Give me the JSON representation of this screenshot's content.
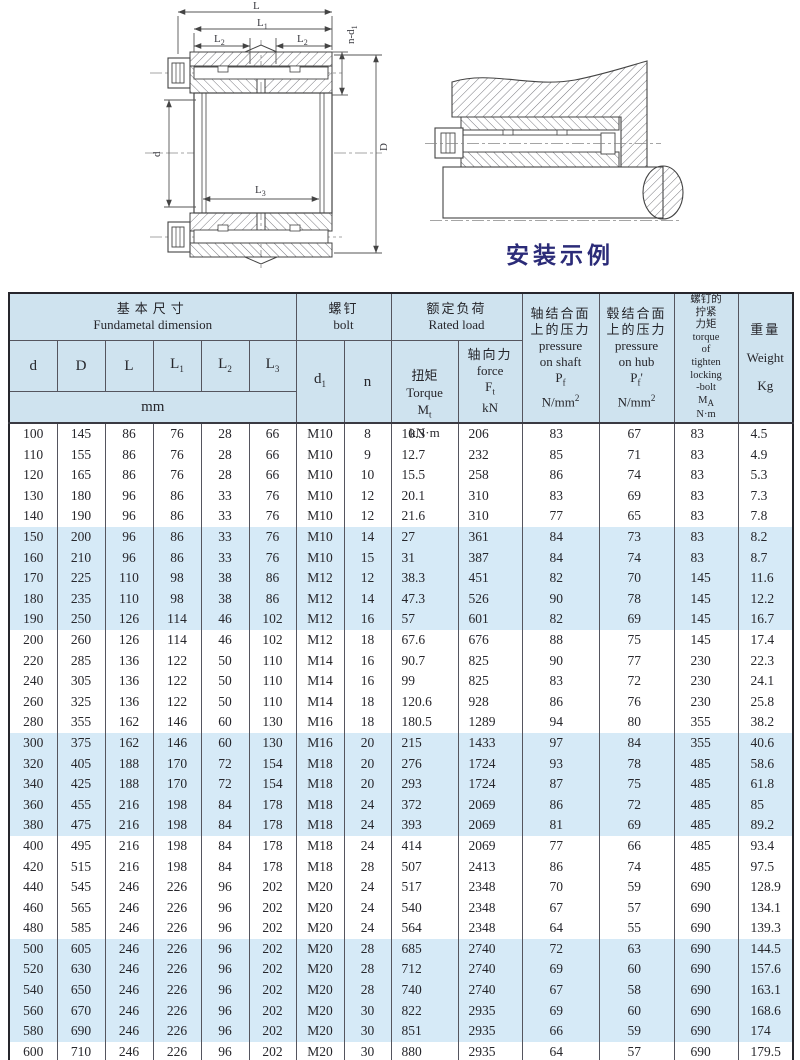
{
  "drawings": {
    "left": {
      "labels": {
        "L": "L",
        "L1": {
          "b": "L",
          "s": "1"
        },
        "L2": {
          "b": "L",
          "s": "2"
        },
        "L3": {
          "b": "L",
          "s": "3"
        },
        "nd1": {
          "b": "n-d",
          "s": "1"
        },
        "d": "d",
        "D": "D"
      }
    },
    "right": {
      "caption": "安装示例",
      "caption_color": "#2b2b78"
    }
  },
  "table": {
    "header": {
      "basic": {
        "cn": "基本尺寸",
        "en": "Fundametal  dimension"
      },
      "mm": "mm",
      "bolt": {
        "cn": "螺钉",
        "en": "bolt"
      },
      "rated": {
        "cn": "额定负荷",
        "en": "Rated load"
      },
      "cols": {
        "d": "d",
        "Dd": "D",
        "L": "L",
        "L1": {
          "b": "L",
          "s": "1"
        },
        "L2": {
          "b": "L",
          "s": "2"
        },
        "L3": {
          "b": "L",
          "s": "3"
        },
        "d1": {
          "b": "d",
          "s": "1"
        },
        "n": "n"
      },
      "torque": {
        "cn": "扭矩",
        "en": "Torque",
        "sym": "M",
        "sub": "t",
        "unit": "kN·m"
      },
      "force": {
        "cn": "轴向力",
        "en": "force",
        "sym": "F",
        "sub": "t",
        "unit": "kN"
      },
      "pshaft": {
        "cn1": "轴结合面",
        "cn2": "上的压力",
        "en1": "pressure",
        "en2": "on shaft",
        "sym": "P",
        "sub": "f",
        "unit": "N/mm",
        "sup": "2"
      },
      "phub": {
        "cn1": "毂结合面",
        "cn2": "上的压力",
        "en1": "pressure",
        "en2": "on hub",
        "sym": "P",
        "sub": "f",
        "prime": "'",
        "unit": "N/mm",
        "sup": "2"
      },
      "ma": {
        "cn1": "螺钉的",
        "cn2": "拧紧",
        "cn3": "力矩",
        "en1": "torque",
        "en2": "of",
        "en3": "tighten",
        "en4": "locking",
        "en5": "-bolt",
        "sym": "M",
        "sub": "A",
        "unit": "N·m"
      },
      "weight": {
        "cn": "重量",
        "en": "Weight",
        "unit": "Kg"
      }
    },
    "colors": {
      "header_bg": "#cfe3ef",
      "band_bg": "#d6eaf7",
      "grid": "#55555e"
    },
    "rows": [
      {
        "band": "w",
        "c": [
          "100",
          "145",
          "86",
          "76",
          "28",
          "66",
          "M10",
          "8",
          "10.3",
          "206",
          "83",
          "67",
          "83",
          "4.5"
        ]
      },
      {
        "band": "w",
        "c": [
          "110",
          "155",
          "86",
          "76",
          "28",
          "66",
          "M10",
          "9",
          "12.7",
          "232",
          "85",
          "71",
          "83",
          "4.9"
        ]
      },
      {
        "band": "w",
        "c": [
          "120",
          "165",
          "86",
          "76",
          "28",
          "66",
          "M10",
          "10",
          "15.5",
          "258",
          "86",
          "74",
          "83",
          "5.3"
        ]
      },
      {
        "band": "w",
        "c": [
          "130",
          "180",
          "96",
          "86",
          "33",
          "76",
          "M10",
          "12",
          "20.1",
          "310",
          "83",
          "69",
          "83",
          "7.3"
        ]
      },
      {
        "band": "w",
        "c": [
          "140",
          "190",
          "96",
          "86",
          "33",
          "76",
          "M10",
          "12",
          "21.6",
          "310",
          "77",
          "65",
          "83",
          "7.8"
        ]
      },
      {
        "band": "b",
        "c": [
          "150",
          "200",
          "96",
          "86",
          "33",
          "76",
          "M10",
          "14",
          "27",
          "361",
          "84",
          "73",
          "83",
          "8.2"
        ]
      },
      {
        "band": "b",
        "c": [
          "160",
          "210",
          "96",
          "86",
          "33",
          "76",
          "M10",
          "15",
          "31",
          "387",
          "84",
          "74",
          "83",
          "8.7"
        ]
      },
      {
        "band": "b",
        "c": [
          "170",
          "225",
          "110",
          "98",
          "38",
          "86",
          "M12",
          "12",
          "38.3",
          "451",
          "82",
          "70",
          "145",
          "11.6"
        ]
      },
      {
        "band": "b",
        "c": [
          "180",
          "235",
          "110",
          "98",
          "38",
          "86",
          "M12",
          "14",
          "47.3",
          "526",
          "90",
          "78",
          "145",
          "12.2"
        ]
      },
      {
        "band": "b",
        "c": [
          "190",
          "250",
          "126",
          "114",
          "46",
          "102",
          "M12",
          "16",
          "57",
          "601",
          "82",
          "69",
          "145",
          "16.7"
        ]
      },
      {
        "band": "w",
        "c": [
          "200",
          "260",
          "126",
          "114",
          "46",
          "102",
          "M12",
          "18",
          "67.6",
          "676",
          "88",
          "75",
          "145",
          "17.4"
        ]
      },
      {
        "band": "w",
        "c": [
          "220",
          "285",
          "136",
          "122",
          "50",
          "110",
          "M14",
          "16",
          "90.7",
          "825",
          "90",
          "77",
          "230",
          "22.3"
        ]
      },
      {
        "band": "w",
        "c": [
          "240",
          "305",
          "136",
          "122",
          "50",
          "110",
          "M14",
          "16",
          "99",
          "825",
          "83",
          "72",
          "230",
          "24.1"
        ]
      },
      {
        "band": "w",
        "c": [
          "260",
          "325",
          "136",
          "122",
          "50",
          "110",
          "M14",
          "18",
          "120.6",
          "928",
          "86",
          "76",
          "230",
          "25.8"
        ]
      },
      {
        "band": "w",
        "c": [
          "280",
          "355",
          "162",
          "146",
          "60",
          "130",
          "M16",
          "18",
          "180.5",
          "1289",
          "94",
          "80",
          "355",
          "38.2"
        ]
      },
      {
        "band": "b",
        "c": [
          "300",
          "375",
          "162",
          "146",
          "60",
          "130",
          "M16",
          "20",
          "215",
          "1433",
          "97",
          "84",
          "355",
          "40.6"
        ]
      },
      {
        "band": "b",
        "c": [
          "320",
          "405",
          "188",
          "170",
          "72",
          "154",
          "M18",
          "20",
          "276",
          "1724",
          "93",
          "78",
          "485",
          "58.6"
        ]
      },
      {
        "band": "b",
        "c": [
          "340",
          "425",
          "188",
          "170",
          "72",
          "154",
          "M18",
          "20",
          "293",
          "1724",
          "87",
          "75",
          "485",
          "61.8"
        ]
      },
      {
        "band": "b",
        "c": [
          "360",
          "455",
          "216",
          "198",
          "84",
          "178",
          "M18",
          "24",
          "372",
          "2069",
          "86",
          "72",
          "485",
          "85"
        ]
      },
      {
        "band": "b",
        "c": [
          "380",
          "475",
          "216",
          "198",
          "84",
          "178",
          "M18",
          "24",
          "393",
          "2069",
          "81",
          "69",
          "485",
          "89.2"
        ]
      },
      {
        "band": "w",
        "c": [
          "400",
          "495",
          "216",
          "198",
          "84",
          "178",
          "M18",
          "24",
          "414",
          "2069",
          "77",
          "66",
          "485",
          "93.4"
        ]
      },
      {
        "band": "w",
        "c": [
          "420",
          "515",
          "216",
          "198",
          "84",
          "178",
          "M18",
          "28",
          "507",
          "2413",
          "86",
          "74",
          "485",
          "97.5"
        ]
      },
      {
        "band": "w",
        "c": [
          "440",
          "545",
          "246",
          "226",
          "96",
          "202",
          "M20",
          "24",
          "517",
          "2348",
          "70",
          "59",
          "690",
          "128.9"
        ]
      },
      {
        "band": "w",
        "c": [
          "460",
          "565",
          "246",
          "226",
          "96",
          "202",
          "M20",
          "24",
          "540",
          "2348",
          "67",
          "57",
          "690",
          "134.1"
        ]
      },
      {
        "band": "w",
        "c": [
          "480",
          "585",
          "246",
          "226",
          "96",
          "202",
          "M20",
          "24",
          "564",
          "2348",
          "64",
          "55",
          "690",
          "139.3"
        ]
      },
      {
        "band": "b",
        "c": [
          "500",
          "605",
          "246",
          "226",
          "96",
          "202",
          "M20",
          "28",
          "685",
          "2740",
          "72",
          "63",
          "690",
          "144.5"
        ]
      },
      {
        "band": "b",
        "c": [
          "520",
          "630",
          "246",
          "226",
          "96",
          "202",
          "M20",
          "28",
          "712",
          "2740",
          "69",
          "60",
          "690",
          "157.6"
        ]
      },
      {
        "band": "b",
        "c": [
          "540",
          "650",
          "246",
          "226",
          "96",
          "202",
          "M20",
          "28",
          "740",
          "2740",
          "67",
          "58",
          "690",
          "163.1"
        ]
      },
      {
        "band": "b",
        "c": [
          "560",
          "670",
          "246",
          "226",
          "96",
          "202",
          "M20",
          "30",
          "822",
          "2935",
          "69",
          "60",
          "690",
          "168.6"
        ]
      },
      {
        "band": "b",
        "c": [
          "580",
          "690",
          "246",
          "226",
          "96",
          "202",
          "M20",
          "30",
          "851",
          "2935",
          "66",
          "59",
          "690",
          "174"
        ]
      },
      {
        "band": "w",
        "c": [
          "600",
          "710",
          "246",
          "226",
          "96",
          "202",
          "M20",
          "30",
          "880",
          "2935",
          "64",
          "57",
          "690",
          "179.5"
        ]
      }
    ]
  }
}
